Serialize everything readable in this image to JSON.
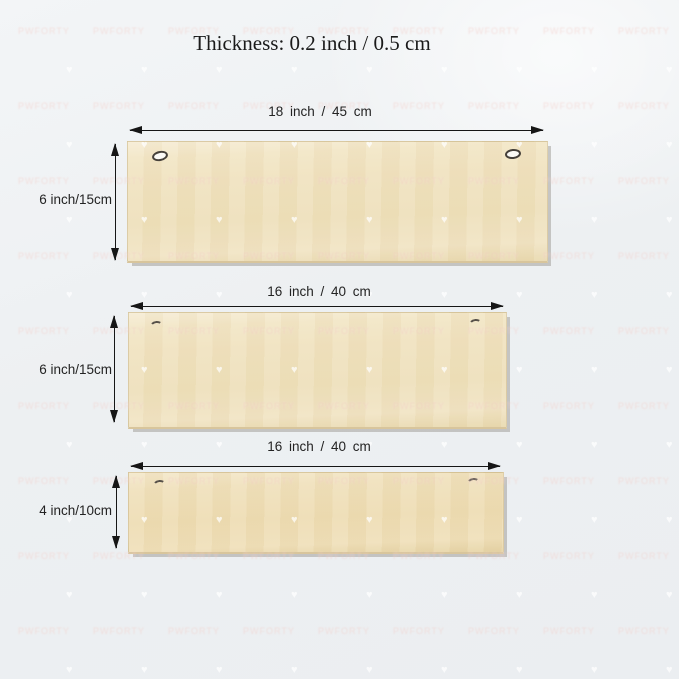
{
  "title": "Thickness: 0.2 inch / 0.5 cm",
  "planks": [
    {
      "width_label": "18 inch / 45 cm",
      "height_label": "6 inch/15cm"
    },
    {
      "width_label": "16 inch / 40 cm",
      "height_label": "6 inch/15cm"
    },
    {
      "width_label": "16 inch / 40 cm",
      "height_label": "4 inch/10cm"
    }
  ],
  "watermark": {
    "text": "PWFORTY",
    "heart_glyph": "♥"
  },
  "colors": {
    "background": "#edf0f2",
    "wood": "#f0e2bf",
    "wood_tan": "#eedfb6",
    "arrow": "#161616",
    "label_text": "#232323",
    "title_text": "#1a1a1a"
  }
}
